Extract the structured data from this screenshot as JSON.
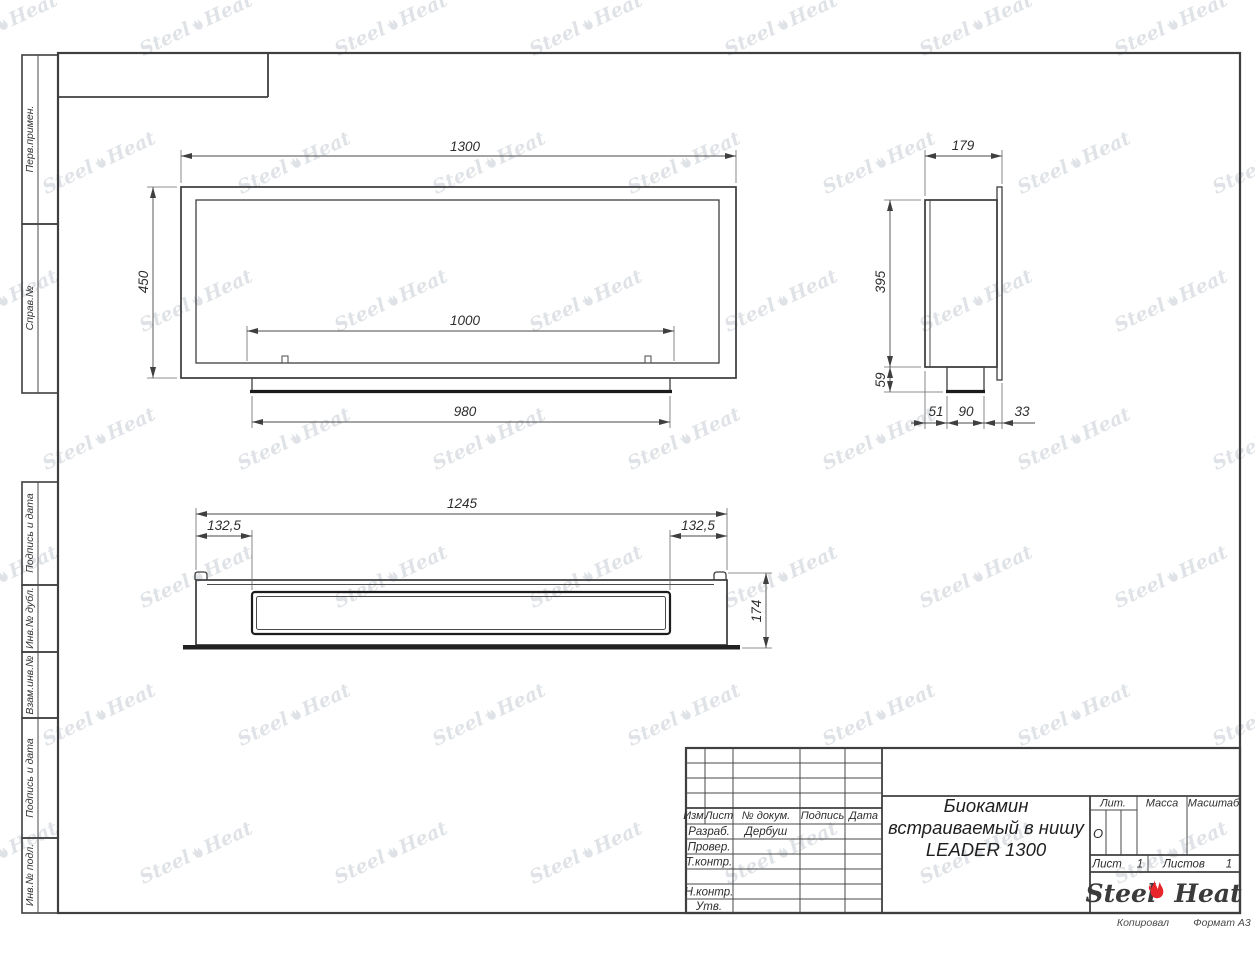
{
  "watermark": {
    "steel": "Steel",
    "heat": "Heat"
  },
  "sidebar": {
    "labels": [
      "Перв.примен.",
      "Справ.№",
      "Подпись и дата",
      "Инв.№ дубл.",
      "Взам.инв.№",
      "Подпись и дата",
      "Инв.№ подл."
    ]
  },
  "front_view": {
    "dim_width": "1300",
    "dim_height": "450",
    "dim_opening": "1000",
    "dim_base": "980"
  },
  "side_view": {
    "dim_depth": "179",
    "dim_height": "395",
    "dim_bottom_height": "59",
    "dim_seg1": "51",
    "dim_seg2": "90",
    "dim_seg3": "33"
  },
  "bottom_view": {
    "dim_width": "1245",
    "dim_offset_left": "132,5",
    "dim_offset_right": "132,5",
    "dim_depth": "174"
  },
  "title_block": {
    "col_izm": "Изм.",
    "col_list": "Лист",
    "col_doc": "№ докум.",
    "col_sign": "Подпись",
    "col_date": "Дата",
    "row_razrab": "Разраб.",
    "razrab_name": "Дербуш",
    "row_prover": "Провер.",
    "row_tkontr": "Т.контр.",
    "row_nkontr": "Н.контр.",
    "row_utv": "Утв.",
    "title_line1": "Биокамин",
    "title_line2": "встраиваемый в нишу",
    "title_line3": "LEADER 1300",
    "lit_header": "Лит.",
    "massa_header": "Масса",
    "masshtab_header": "Масштаб",
    "lit_value": "О",
    "list_label": "Лист",
    "list_value": "1",
    "listov_label": "Листов",
    "listov_value": "1",
    "logo_steel": "Steel",
    "logo_heat": "Heat"
  },
  "footer": {
    "kopiroval": "Копировал",
    "format": "Формат А3"
  }
}
